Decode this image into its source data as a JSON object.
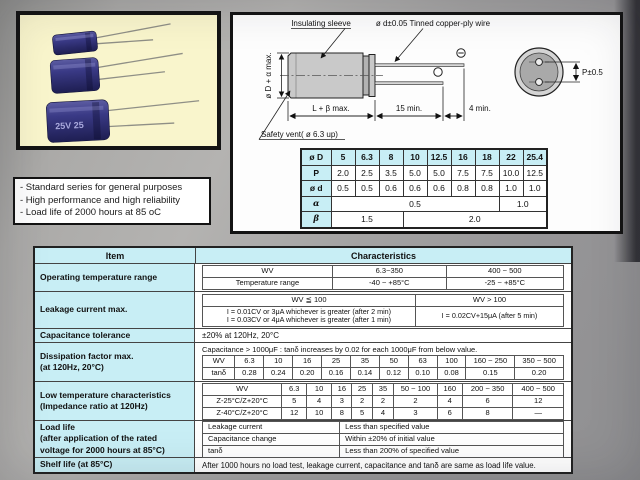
{
  "colors": {
    "accent_cyan": "#c8eef5",
    "photo_background": "#f9f5cc",
    "capacitor_blue": "#35357e",
    "page_gray": "#a2a2a4",
    "diagram_background": "#fdfdfd"
  },
  "photo": {
    "cap_label": "25V 25"
  },
  "diagram": {
    "insulating_sleeve": "Insulating sleeve",
    "wire": "ø d±0.05 Tinned copper-ply wire",
    "diameter": "ø D + α max.",
    "length": "L + β max.",
    "lead_length": "15 min.",
    "tip_length": "4 min.",
    "pitch": "P±0.5",
    "safety_vent": "Safety vent( ø 6.3 up)"
  },
  "dim_table": {
    "header": [
      "ø D",
      "5",
      "6.3",
      "8",
      "10",
      "12.5",
      "16",
      "18",
      "22",
      "25.4"
    ],
    "p_label": "P",
    "p": [
      "2.0",
      "2.5",
      "3.5",
      "5.0",
      "5.0",
      "7.5",
      "7.5",
      "10.0",
      "12.5"
    ],
    "d_label": "ø d",
    "d": [
      "0.5",
      "0.5",
      "0.6",
      "0.6",
      "0.6",
      "0.8",
      "0.8",
      "1.0",
      "1.0"
    ],
    "alpha_label": "α",
    "alpha_small": "0.5",
    "alpha_large": "1.0",
    "beta_label": "β",
    "beta_small": "1.5",
    "beta_large": "2.0"
  },
  "features": {
    "line1": "- Standard series for general purposes",
    "line2": "- High performance and high reliability",
    "line3": "- Load life of 2000 hours at 85 oC"
  },
  "table": {
    "header_item": "Item",
    "header_char": "Characteristics",
    "op_temp": {
      "item": "Operating temperature range",
      "wv_label": "WV",
      "wv_1": "6.3~350",
      "wv_2": "400 ~ 500",
      "temp_label": "Temperature range",
      "temp_1": "-40 ~ +85°C",
      "temp_2": "-25 ~ +85°C"
    },
    "leakage": {
      "item": "Leakage current max.",
      "h1": "WV ≦ 100",
      "h2": "WV > 100",
      "c1_line1": "I = 0.01CV or 3μA whichever is greater (after 2 min)",
      "c1_line2": "I = 0.03CV or 4μA whichever is greater (after 1 min)",
      "c2": "I = 0.02CV+15μA (after 5 min)"
    },
    "tolerance": {
      "item": "Capacitance tolerance",
      "value": "±20% at 120Hz, 20°C"
    },
    "dissipation": {
      "item_line1": "Dissipation factor max.",
      "item_line2": "(at 120Hz, 20°C)",
      "note": "Capacitance > 1000μF : tanδ increases by 0.02 for each 1000μF from below value.",
      "wv_label": "WV",
      "wv": [
        "6.3",
        "10",
        "16",
        "25",
        "35",
        "50",
        "63",
        "100",
        "160 ~ 250",
        "350 ~ 500"
      ],
      "tan_label": "tanδ",
      "tan": [
        "0.28",
        "0.24",
        "0.20",
        "0.16",
        "0.14",
        "0.12",
        "0.10",
        "0.08",
        "0.15",
        "0.20"
      ]
    },
    "low_temp": {
      "item_line1": "Low temperature characteristics",
      "item_line2": "(Impedance ratio at 120Hz)",
      "wv_label": "WV",
      "wv": [
        "6.3",
        "10",
        "16",
        "25",
        "35",
        "50 ~ 100",
        "160",
        "200 ~ 350",
        "400 ~ 500"
      ],
      "z25_label": "Z-25°C/Z+20°C",
      "z25": [
        "5",
        "4",
        "3",
        "2",
        "2",
        "2",
        "4",
        "6",
        "12"
      ],
      "z40_label": "Z-40°C/Z+20°C",
      "z40": [
        "12",
        "10",
        "8",
        "5",
        "4",
        "3",
        "6",
        "8",
        "—"
      ]
    },
    "load_life": {
      "item_line1": "Load life",
      "item_line2": "(after application of the rated",
      "item_line3": "voltage for 2000 hours at 85°C)",
      "r1_label": "Leakage current",
      "r1_value": "Less than specified value",
      "r2_label": "Capacitance change",
      "r2_value": "Within ±20% of initial value",
      "r3_label": "tanδ",
      "r3_value": "Less than 200% of specified value"
    },
    "shelf": {
      "item": "Shelf life (at 85°C)",
      "value": "After 1000 hours no load test, leakage current, capacitance and tanδ are same as load life value."
    }
  }
}
